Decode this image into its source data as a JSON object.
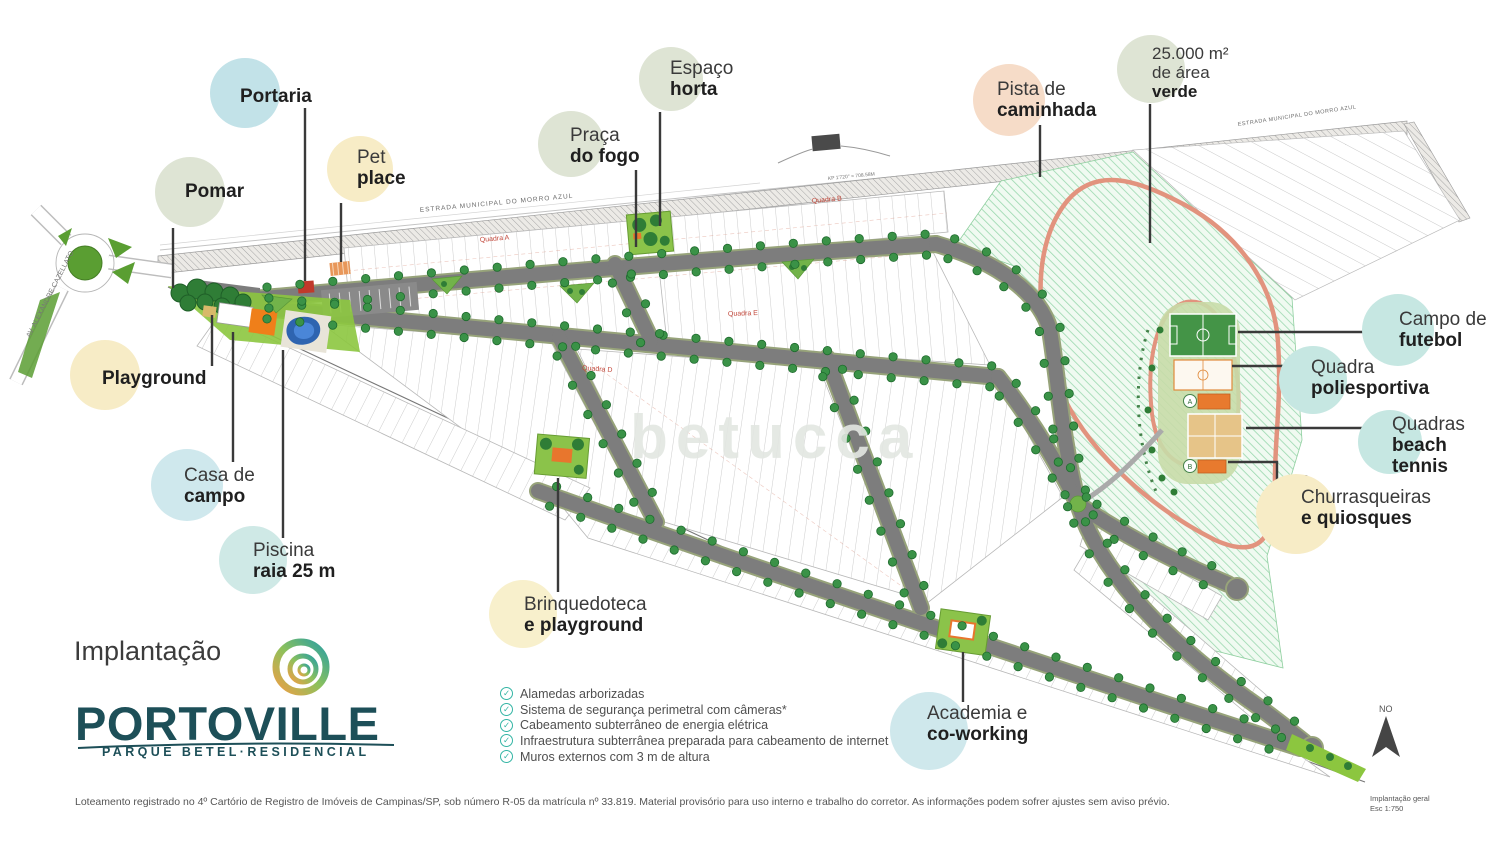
{
  "watermark": "betucca",
  "callouts": {
    "pomar": {
      "line1": "Pomar"
    },
    "portaria": {
      "line1": "Portaria"
    },
    "pet_place": {
      "line1": "Pet",
      "line2": "place"
    },
    "espaco_horta": {
      "line1": "Espaço",
      "line2": "horta"
    },
    "praca_do_fogo": {
      "line1": "Praça",
      "line2": "do fogo"
    },
    "pista_caminhada": {
      "line1": "Pista de",
      "line2": "caminhada"
    },
    "area_verde": {
      "line1": "25.000 m²",
      "line2": "de área",
      "line3": "verde"
    },
    "campo_futebol": {
      "line1": "Campo de",
      "line2": "futebol"
    },
    "quadra_poliesportiva": {
      "line1": "Quadra",
      "line2": "poliesportiva"
    },
    "quadras_beach_tennis": {
      "line1": "Quadras",
      "line2": "beach",
      "line3": "tennis"
    },
    "churrasqueiras": {
      "ref": "A B",
      "line1": "Churrasqueiras",
      "line2": "e quiosques"
    },
    "playground": {
      "line1": "Playground"
    },
    "casa_campo": {
      "line1": "Casa de",
      "line2": "campo"
    },
    "piscina": {
      "line1": "Piscina",
      "line2": "raia 25 m"
    },
    "brinquedoteca": {
      "line1": "Brinquedoteca",
      "line2": "e playground"
    },
    "academia": {
      "line1": "Academia e",
      "line2": "co-working"
    }
  },
  "map_labels": {
    "road_top_left": "ESTRADA MUNICIPAL DO MORRO AZUL",
    "road_top_right": "ESTRADA MUNICIPAL DO MORRO AZUL",
    "road_left": "AV. ALEXANDRE CAZELLATO",
    "road_marker": "KP 1'720'' = 708.58M",
    "quadra_a": "Quadra A",
    "quadra_b": "Quadra B",
    "quadra_d": "Quadra D",
    "quadra_e": "Quadra E",
    "kiosk_a": "A",
    "kiosk_b": "B",
    "compass": "NO",
    "scale_title": "Implantação geral",
    "scale_value": "Esc 1:750"
  },
  "title_block": {
    "heading": "Implantação",
    "brand": "PORTOVILLE",
    "brand_sub": "PARQUE BETEL·RESIDENCIAL"
  },
  "checklist": {
    "items": [
      "Alamedas arborizadas",
      "Sistema de segurança perimetral com câmeras*",
      "Cabeamento subterrâneo de energia elétrica",
      "Infraestrutura subterrânea preparada para cabeamento de internet",
      "Muros externos com 3 m de altura"
    ]
  },
  "footer": {
    "text": "Loteamento registrado no 4º Cartório de Registro de Imóveis de Campinas/SP, sob número R-05 da matrícula nº 33.819. Material provisório para uso interno e trabalho do corretor. As informações podem sofrer ajustes sem aviso prévio."
  },
  "colors": {
    "sage_circle": "#dee4d4",
    "teal_circle": "#c6e7e2",
    "blue_circle": "#cfe8ed",
    "yellow_circle": "#f7ecc6",
    "peach_circle": "#f6dcc8",
    "brand_teal": "#1d4f58",
    "check_teal": "#35b5a5",
    "track_orange": "#e2937e",
    "street_gray": "#7d7d7d",
    "tree_green": "#3a9247",
    "quadra_red": "#c2473a"
  }
}
